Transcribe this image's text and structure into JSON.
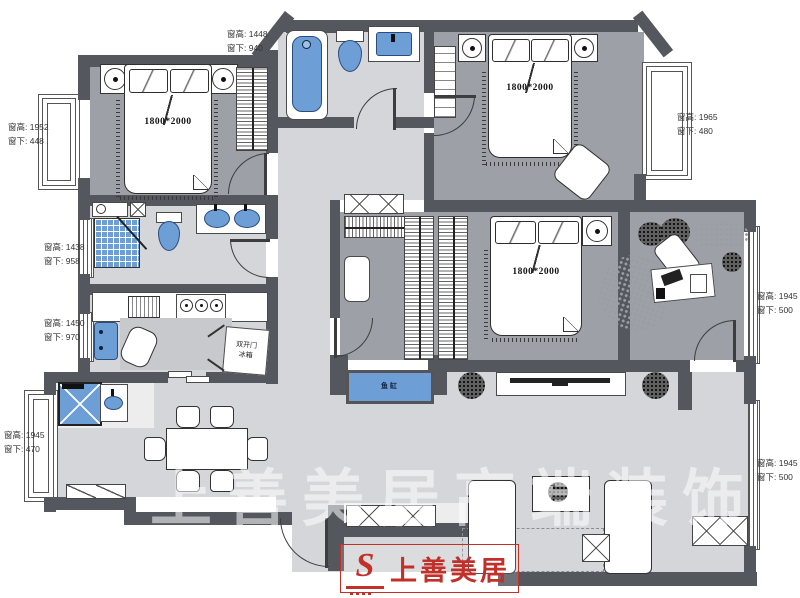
{
  "annotations": [
    {
      "id": "win-top-bathroom",
      "line1": "窗高: 1448",
      "line2": "窗下: 940"
    },
    {
      "id": "win-left-bedroom1",
      "line1": "窗高: 1952",
      "line2": "窗下: 448"
    },
    {
      "id": "win-left-bathroom2",
      "line1": "窗高: 1438",
      "line2": "窗下: 958"
    },
    {
      "id": "win-left-kitchen",
      "line1": "窗高: 1450",
      "line2": "窗下: 970"
    },
    {
      "id": "win-left-dining",
      "line1": "窗高: 1945",
      "line2": "窗下: 470"
    },
    {
      "id": "win-right-bedroom2",
      "line1": "窗高: 1965",
      "line2": "窗下: 480"
    },
    {
      "id": "win-right-study",
      "line1": "窗高: 1945",
      "line2": "窗下: 500"
    },
    {
      "id": "win-right-living",
      "line1": "窗高: 1945",
      "line2": "窗下: 500"
    }
  ],
  "beds": {
    "bed1_size": "1800*2000",
    "bed2_size": "1800*2000",
    "bed3_size": "1800*2000"
  },
  "appliances": {
    "fridge_line1": "双开门",
    "fridge_line2": "冰箱",
    "fish_tank": "鱼缸"
  },
  "watermark": {
    "brand": "上善美居",
    "logo_letter": "S",
    "ghost": "上善美居高端装饰"
  },
  "colors": {
    "wall": "#54585e",
    "room_floor": "#9da1a7",
    "corridor_floor": "#d4d6d9",
    "fixture_blue": "#6d9ed6",
    "brand_red": "#c2302a"
  }
}
